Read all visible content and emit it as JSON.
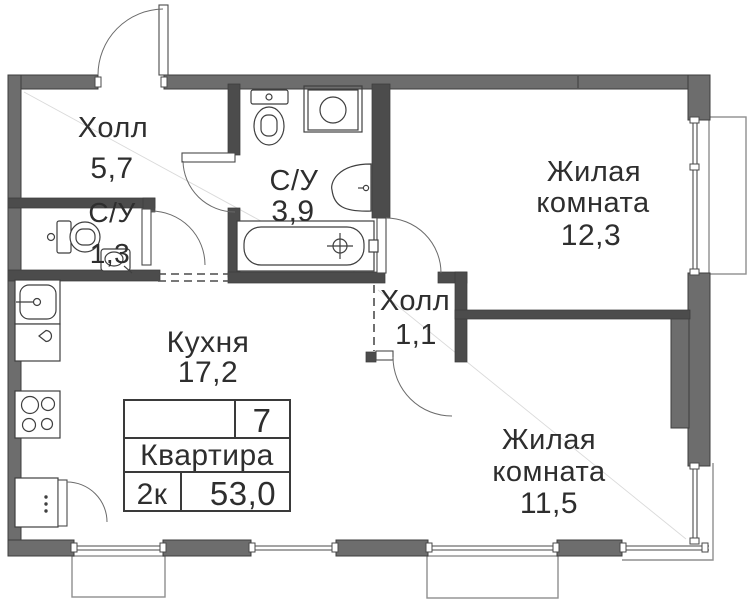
{
  "plan": {
    "rooms": {
      "hall_main": {
        "name": "Холл",
        "area": "5,7"
      },
      "bathroom_small": {
        "name": "С/У",
        "area": "1,3"
      },
      "bathroom_main": {
        "name": "С/У",
        "area": "3,9"
      },
      "living1": {
        "name1": "Жилая",
        "name2": "комната",
        "area": "12,3"
      },
      "hall_inner": {
        "name": "Холл",
        "area": "1,1"
      },
      "kitchen": {
        "name": "Кухня",
        "area": "17,2"
      },
      "living2": {
        "name1": "Жилая",
        "name2": "комната",
        "area": "11,5"
      }
    },
    "table": {
      "number": "7",
      "label": "Квартира",
      "rooms": "2к",
      "area": "53,0"
    },
    "colors": {
      "wall_exterior": "#6d6d6d",
      "wall_interior": "#4c4c4c",
      "text": "#2e2e2e",
      "balcony_outline": "#8f8f8f"
    }
  }
}
